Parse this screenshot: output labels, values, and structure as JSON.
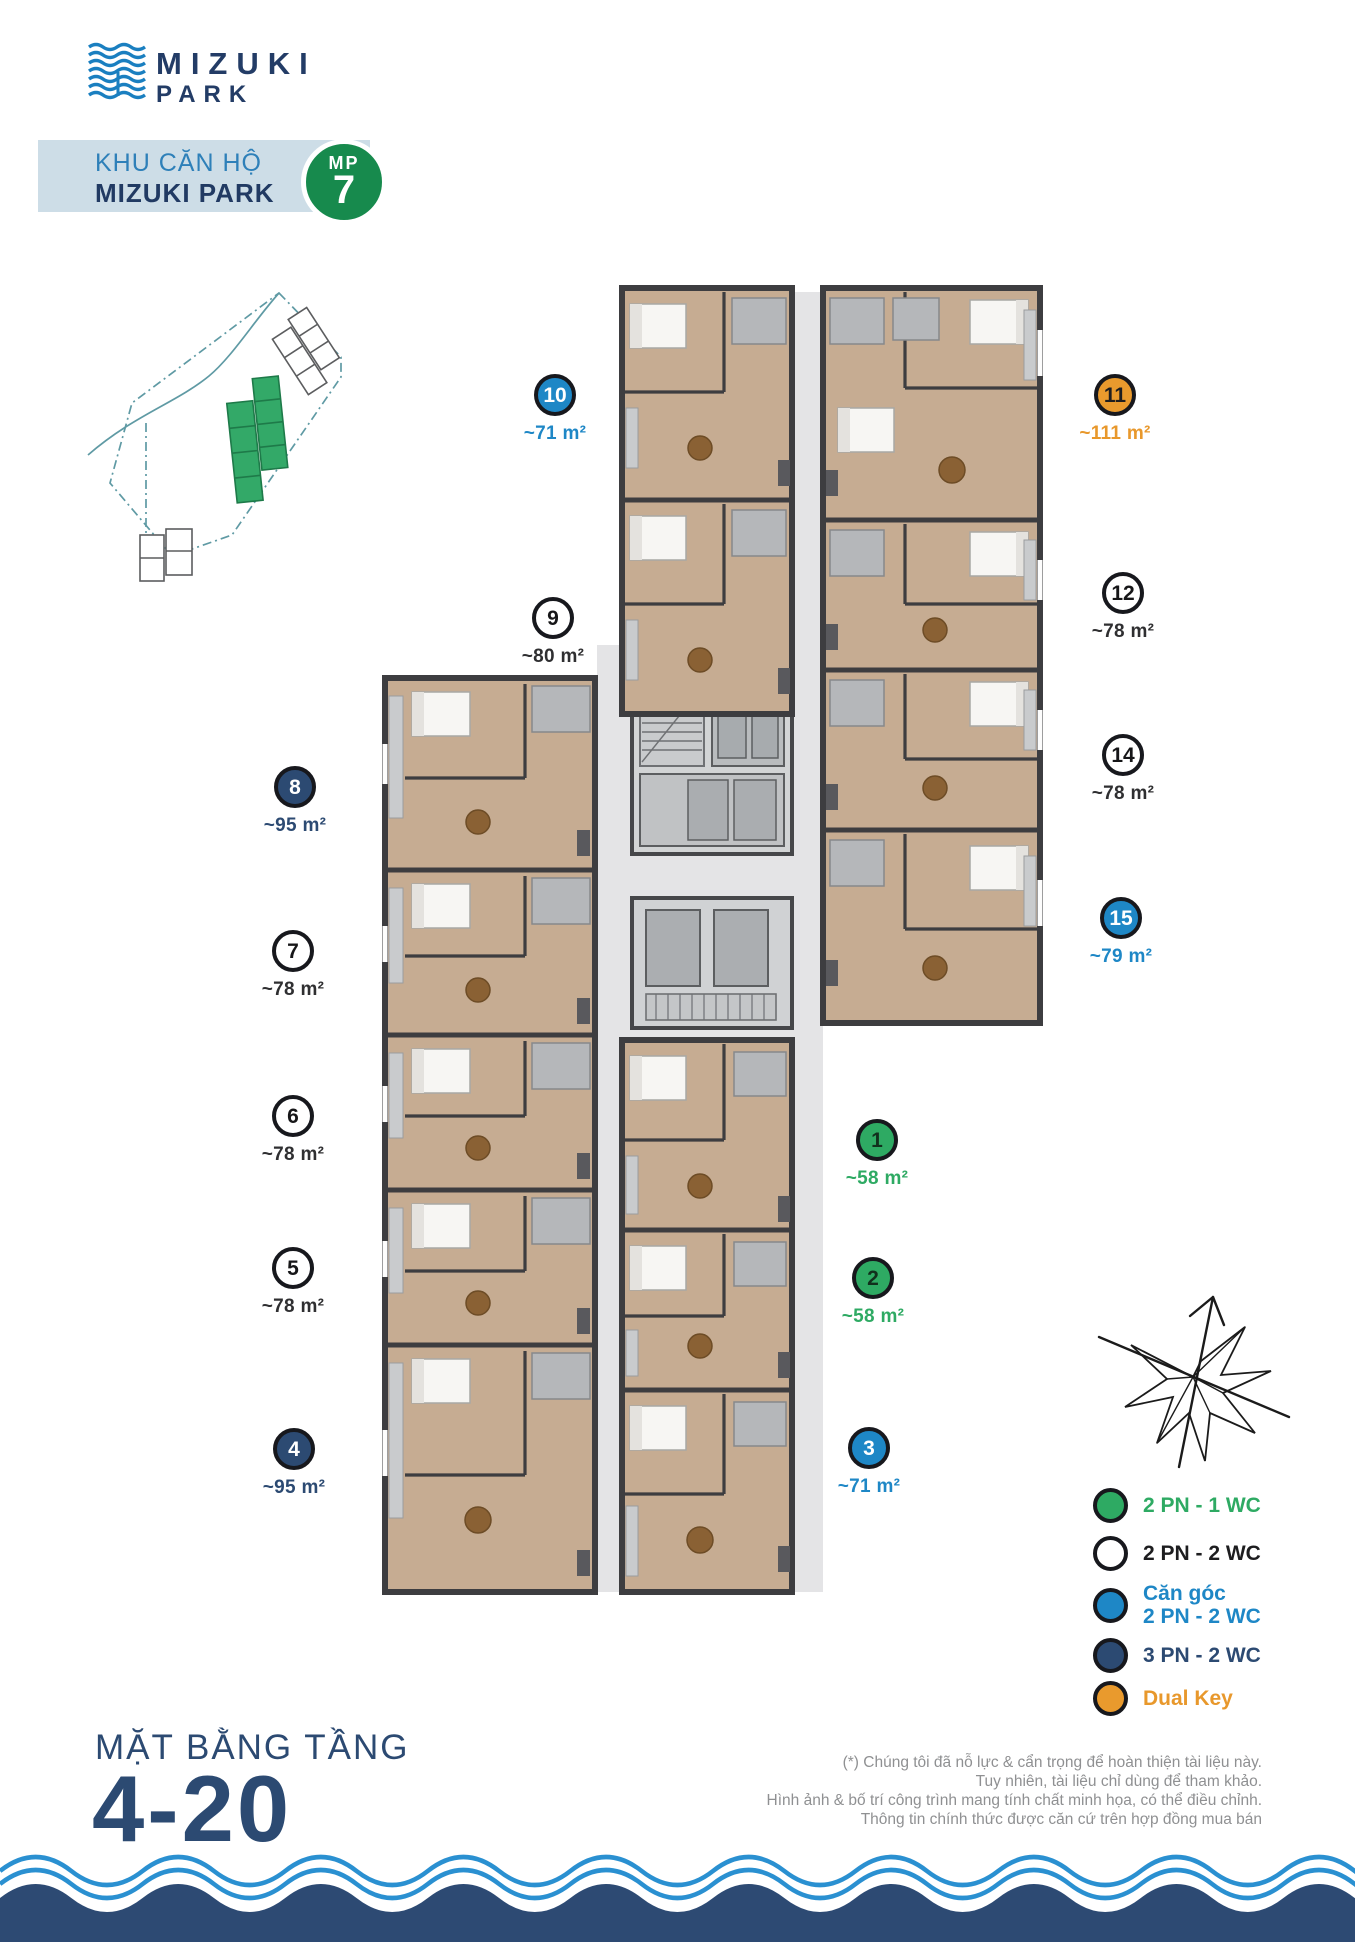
{
  "brand": {
    "logo_line1": "MIZUKI",
    "logo_line2": "PARK"
  },
  "header": {
    "subtitle": "KHU CĂN HỘ",
    "title": "MIZUKI PARK",
    "badge_prefix": "MP",
    "badge_number": "7"
  },
  "units": [
    {
      "id": "10",
      "area": "~71 m²",
      "type": "corner-2pn-2wc"
    },
    {
      "id": "9",
      "area": "~80 m²",
      "type": "2pn-2wc"
    },
    {
      "id": "8",
      "area": "~95 m²",
      "type": "3pn-2wc"
    },
    {
      "id": "7",
      "area": "~78 m²",
      "type": "2pn-2wc"
    },
    {
      "id": "6",
      "area": "~78 m²",
      "type": "2pn-2wc"
    },
    {
      "id": "5",
      "area": "~78 m²",
      "type": "2pn-2wc"
    },
    {
      "id": "4",
      "area": "~95 m²",
      "type": "3pn-2wc"
    },
    {
      "id": "11",
      "area": "~111 m²",
      "type": "dual-key"
    },
    {
      "id": "12",
      "area": "~78 m²",
      "type": "2pn-2wc"
    },
    {
      "id": "14",
      "area": "~78 m²",
      "type": "2pn-2wc"
    },
    {
      "id": "15",
      "area": "~79 m²",
      "type": "corner-2pn-2wc"
    },
    {
      "id": "1",
      "area": "~58 m²",
      "type": "2pn-1wc"
    },
    {
      "id": "2",
      "area": "~58 m²",
      "type": "2pn-1wc"
    },
    {
      "id": "3",
      "area": "~71 m²",
      "type": "corner-2pn-2wc"
    }
  ],
  "legend": {
    "items": [
      {
        "line1": "2 PN - 1 WC",
        "type": "green"
      },
      {
        "line1": "2 PN - 2 WC",
        "type": "white"
      },
      {
        "line1": "Căn góc",
        "line2": "2 PN - 2 WC",
        "type": "blue"
      },
      {
        "line1": "3 PN - 2 WC",
        "type": "navy"
      },
      {
        "line1": "Dual Key",
        "type": "orange"
      }
    ]
  },
  "footer": {
    "floor_label": "MẶT BẰNG TẦNG",
    "floor_range": "4-20",
    "disclaimer": [
      "(*) Chúng tôi đã nỗ lực & cẩn trọng để hoàn thiện tài liệu này.",
      "Tuy nhiên, tài liệu chỉ dùng để tham khảo.",
      "Hình ảnh & bố trí công trình mang tính chất minh họa, có thể điều chỉnh.",
      "Thông tin chính thức được căn cứ trên hợp đồng mua bán"
    ]
  },
  "colors": {
    "corner_blue": "#1e87c6",
    "green": "#2eaa63",
    "navy": "#2c4a72",
    "orange": "#e99a2d",
    "band_background": "#cddde7",
    "badge_green": "#178a4d",
    "wave_line_blue": "#2a90d1",
    "wave_band_navy": "#2d4a73"
  }
}
